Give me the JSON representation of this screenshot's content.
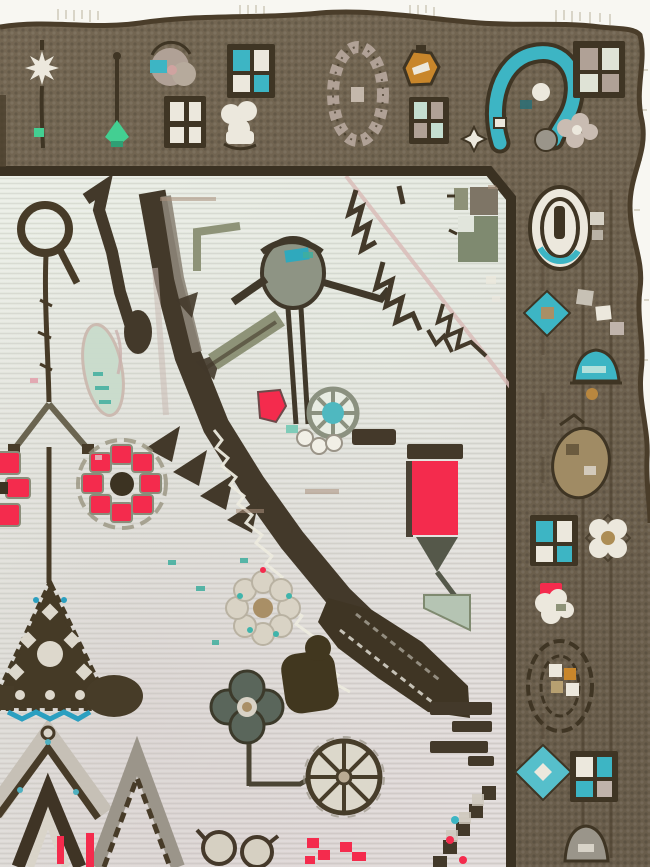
{
  "scene": {
    "type": "photograph",
    "subject": "corner fragment of an antique hand-knotted rug",
    "view": "top-left portion of field with top and right guard borders, white backdrop visible along fringed top edge and right selvedge",
    "field_description": "pale ivory-celadon field with angular dark-brown serrated diagonal band, stylized rosettes, tulip, bird and vine motifs",
    "border_description": "walnut-brown main border with quartered squares, boteh, oval rosettes, teal diamonds and blossom motifs",
    "motifs": [
      "white eight-point star with stem",
      "mint-green sprout",
      "taupe rosette with teal fleck",
      "quartered pane squares",
      "oval mauve petal rosette",
      "gold bud",
      "large teal boteh",
      "corner pane square with blossom",
      "oval medallion with teal arcs",
      "teal diamonds",
      "teal arch",
      "tan boteh",
      "white blossom",
      "red-capped blossom",
      "oval outline with gold squares",
      "gray mound",
      "loop-and-stem plant",
      "serrated dark diagonal band with white zigzag",
      "red pinwheel rosettes",
      "red tulip panel",
      "teal wheel rosette",
      "bird figure",
      "beige rosette with teal dots",
      "dark green rosette",
      "spoked wheel blossom",
      "stepped triangle medallion with teal zigzag",
      "gabled arch motifs",
      "small red ornaments"
    ]
  },
  "palette": {
    "page_bg": "#f8f7f2",
    "fringe": "#d9d5c8",
    "border_brown": "#6f6252",
    "edge_dark": "#4a3d2a",
    "guard_dark": "#3a3122",
    "outline_dark": "#3f3524",
    "field_light": "#e2e6dd",
    "red": "#f42b4d",
    "teal": "#3db5c4",
    "teal_deep": "#2b9fc0",
    "mint_green": "#43cf92",
    "sage": "#8e9378",
    "sage_dark": "#5a665b",
    "olive_blob": "#41371f",
    "gold": "#c8862b",
    "tan": "#a98f66",
    "mauve": "#b0a196",
    "white_motif": "#ece8dd",
    "gray_motif": "#9a958a",
    "pink_line": "#d9bcb8"
  }
}
